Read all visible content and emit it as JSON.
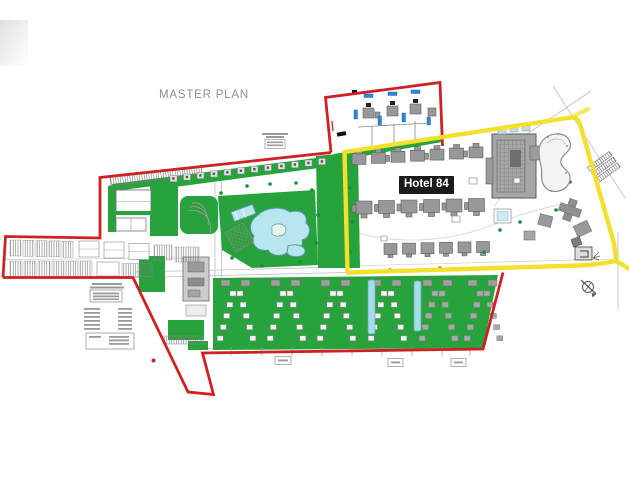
{
  "plan": {
    "title": "MASTER PLAN",
    "hotel_label": "Hotel 84",
    "colors": {
      "boundary_red": "#ce2121",
      "parcel_yellow": "#f2e02c",
      "landscape_green": "#28a23c",
      "lagoon_blue": "#b7e6ef",
      "lap_pool_blue": "#a6dde9",
      "villa_pool_blue": "#2e86d6",
      "building_gray": "#9a9a9a",
      "title_gray": "#8e8e8e",
      "hotel_label_bg": "#1b1b1b",
      "hotel_label_text": "#ffffff"
    }
  }
}
